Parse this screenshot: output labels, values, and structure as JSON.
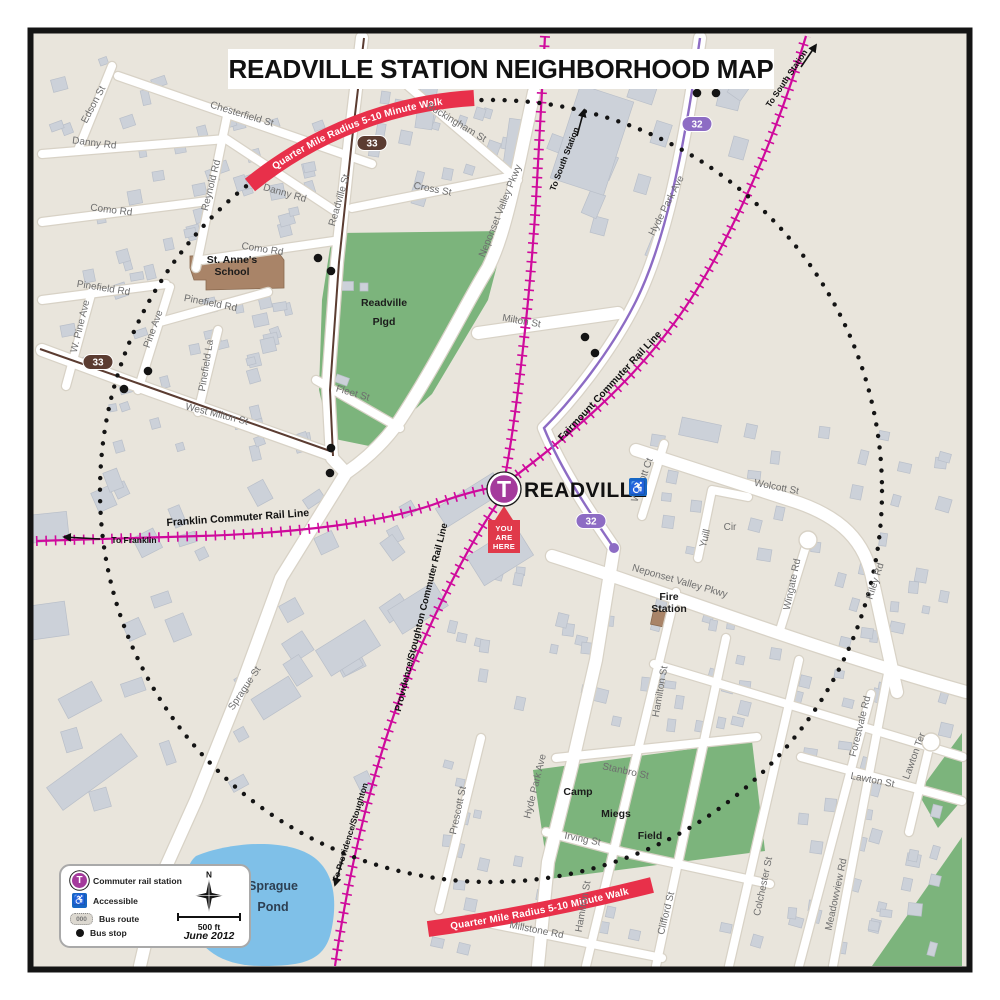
{
  "title": "READVILLE STATION NEIGHBORHOOD MAP",
  "radius_banner": {
    "text": "Quarter Mile Radius   5-10 Minute Walk"
  },
  "station": {
    "name": "READVILLE",
    "logo_letter": "T",
    "you_are_here": [
      "YOU",
      "ARE",
      "HERE"
    ]
  },
  "legend": {
    "items": [
      {
        "icon": "commuter-rail-station",
        "label": "Commuter rail station"
      },
      {
        "icon": "accessible",
        "label": "Accessible"
      },
      {
        "icon": "bus-route",
        "label": "Bus route"
      },
      {
        "icon": "bus-stop",
        "label": "Bus stop"
      }
    ],
    "bus_route_icon_text": "000",
    "scale_label": "500 ft",
    "date": "June 2012",
    "compass_label": "N"
  },
  "rail_labels": [
    {
      "name": "Franklin Commuter Rail Line",
      "x": 238,
      "y": 521,
      "r": -4,
      "s": 10.5
    },
    {
      "name": "Fairmount Commuter Rail Line",
      "x": 612,
      "y": 388,
      "r": -47,
      "s": 10
    },
    {
      "name": "Providence/Stoughton Commuter Rail Line",
      "x": 424,
      "y": 618,
      "r": -76,
      "s": 9.5
    }
  ],
  "directions": [
    {
      "name": "To Franklin",
      "x": 134,
      "y": 543,
      "r": 0,
      "ax1": 100,
      "ay1": 539,
      "ax2": 64,
      "ay2": 537
    },
    {
      "name": "To South Station",
      "x": 567,
      "y": 160,
      "r": -69,
      "ax1": 577,
      "ay1": 136,
      "ax2": 584,
      "ay2": 110
    },
    {
      "name": "To South Station",
      "x": 789,
      "y": 80,
      "r": -56,
      "ax1": 801,
      "ay1": 67,
      "ax2": 816,
      "ay2": 45
    },
    {
      "name": "To Providence/Stoughton",
      "x": 353,
      "y": 833,
      "r": -73,
      "ax1": 343,
      "ay1": 858,
      "ax2": 335,
      "ay2": 885
    }
  ],
  "bus_shields": [
    {
      "route": "33",
      "x": 372,
      "y": 143,
      "color": "#5b3c31"
    },
    {
      "route": "33",
      "x": 98,
      "y": 362,
      "color": "#5b3c31"
    },
    {
      "route": "32",
      "x": 697,
      "y": 124,
      "color": "#8d6cc4"
    },
    {
      "route": "32",
      "x": 591,
      "y": 521,
      "color": "#8d6cc4"
    }
  ],
  "bus_stops": [
    [
      697,
      93
    ],
    [
      716,
      93
    ],
    [
      318,
      258
    ],
    [
      331,
      271
    ],
    [
      148,
      371
    ],
    [
      124,
      389
    ],
    [
      331,
      448
    ],
    [
      330,
      473
    ],
    [
      585,
      337
    ],
    [
      595,
      353
    ]
  ],
  "places": [
    {
      "lines": [
        "St. Anne's",
        "School"
      ],
      "x": 232,
      "y": 263,
      "lh": 12,
      "cls": "place"
    },
    {
      "lines": [
        "Readville",
        "Plgd"
      ],
      "x": 384,
      "y": 306,
      "lh": 19,
      "cls": "place"
    },
    {
      "lines": [
        "Camp"
      ],
      "x": 578,
      "y": 795,
      "lh": 12,
      "cls": "place"
    },
    {
      "lines": [
        "Miegs"
      ],
      "x": 616,
      "y": 817,
      "lh": 12,
      "cls": "place"
    },
    {
      "lines": [
        "Field"
      ],
      "x": 650,
      "y": 839,
      "lh": 12,
      "cls": "place"
    },
    {
      "lines": [
        "Fire",
        "Station"
      ],
      "x": 669,
      "y": 600,
      "lh": 12,
      "cls": "place"
    },
    {
      "lines": [
        "Sprague",
        "Pond"
      ],
      "x": 273,
      "y": 890,
      "lh": 21,
      "cls": "pondlbl"
    }
  ],
  "streets": [
    {
      "name": "Edson St",
      "x": 96,
      "y": 106,
      "r": -62
    },
    {
      "name": "Chesterfield St",
      "x": 241,
      "y": 117,
      "r": 17
    },
    {
      "name": "Danny Rd",
      "x": 94,
      "y": 146,
      "r": 7
    },
    {
      "name": "Reynold Rd",
      "x": 214,
      "y": 186,
      "r": -76
    },
    {
      "name": "Danny Rd",
      "x": 284,
      "y": 196,
      "r": 16
    },
    {
      "name": "Como Rd",
      "x": 111,
      "y": 213,
      "r": 7
    },
    {
      "name": "Como Rd",
      "x": 262,
      "y": 252,
      "r": 9
    },
    {
      "name": "Readville St",
      "x": 342,
      "y": 201,
      "r": -74
    },
    {
      "name": "Buckingham St",
      "x": 455,
      "y": 125,
      "r": 31
    },
    {
      "name": "Cross St",
      "x": 432,
      "y": 192,
      "r": 11
    },
    {
      "name": "Neponset  Valley Pkwy",
      "x": 503,
      "y": 212,
      "r": -68
    },
    {
      "name": "Pinefield  Rd",
      "x": 103,
      "y": 291,
      "r": 9
    },
    {
      "name": "W. Pine Ave",
      "x": 83,
      "y": 327,
      "r": -76
    },
    {
      "name": "Pine Ave",
      "x": 156,
      "y": 330,
      "r": -70
    },
    {
      "name": "Pinefield Rd",
      "x": 210,
      "y": 306,
      "r": 11
    },
    {
      "name": "Pinefield La",
      "x": 209,
      "y": 366,
      "r": -81
    },
    {
      "name": "West Milton St",
      "x": 216,
      "y": 417,
      "r": 14
    },
    {
      "name": "Fleet St",
      "x": 352,
      "y": 396,
      "r": 16
    },
    {
      "name": "Milton St",
      "x": 521,
      "y": 324,
      "r": 10
    },
    {
      "name": "Hyde Park Ave",
      "x": 669,
      "y": 207,
      "r": -63
    },
    {
      "name": "Wolcott Ct",
      "x": 645,
      "y": 481,
      "r": -70
    },
    {
      "name": "Wolcott St",
      "x": 776,
      "y": 490,
      "r": 11
    },
    {
      "name": "Yuill",
      "x": 708,
      "y": 539,
      "r": -76
    },
    {
      "name": "Cir",
      "x": 730,
      "y": 530,
      "r": 0
    },
    {
      "name": "Neponset  Valley Pkwy",
      "x": 679,
      "y": 584,
      "r": 16
    },
    {
      "name": "Wingate Rd",
      "x": 795,
      "y": 585,
      "r": -78
    },
    {
      "name": "Riley Rd",
      "x": 878,
      "y": 582,
      "r": -72
    },
    {
      "name": "Hamilton St",
      "x": 663,
      "y": 692,
      "r": -80
    },
    {
      "name": "Forestvale Rd",
      "x": 863,
      "y": 727,
      "r": -76
    },
    {
      "name": "Lawton Ter",
      "x": 917,
      "y": 757,
      "r": -70
    },
    {
      "name": "Lawton St",
      "x": 872,
      "y": 783,
      "r": 11
    },
    {
      "name": "Stanbro St",
      "x": 625,
      "y": 774,
      "r": 12
    },
    {
      "name": "Hyde Park Ave",
      "x": 538,
      "y": 787,
      "r": -76
    },
    {
      "name": "Irving  St",
      "x": 582,
      "y": 842,
      "r": 11
    },
    {
      "name": "Prescott St",
      "x": 461,
      "y": 811,
      "r": -78
    },
    {
      "name": "Sprague St",
      "x": 247,
      "y": 690,
      "r": -56
    },
    {
      "name": "Clifford St",
      "x": 669,
      "y": 914,
      "r": -76
    },
    {
      "name": "Colchester St",
      "x": 766,
      "y": 887,
      "r": -78
    },
    {
      "name": "Meadowview Rd",
      "x": 839,
      "y": 895,
      "r": -78
    },
    {
      "name": "Millstone Rd",
      "x": 536,
      "y": 933,
      "r": 11
    },
    {
      "name": "Hamilton St",
      "x": 586,
      "y": 907,
      "r": -80
    }
  ],
  "colors": {
    "land": "#e9e5dc",
    "road_casing": "#d8d2c6",
    "building": "#ccd1d9",
    "building_edge": "#b9bfc9",
    "park": "#7cb47c",
    "water": "#7fc0e8",
    "rail": "#cf0a9c",
    "bus33": "#5b3c31",
    "bus32": "#8d6cc4",
    "banner": "#e8304a",
    "marker_red": "#e0394a",
    "station_purple": "#a43a9c",
    "accessible_blue": "#1666c4",
    "street_label": "#6e6e6e"
  }
}
